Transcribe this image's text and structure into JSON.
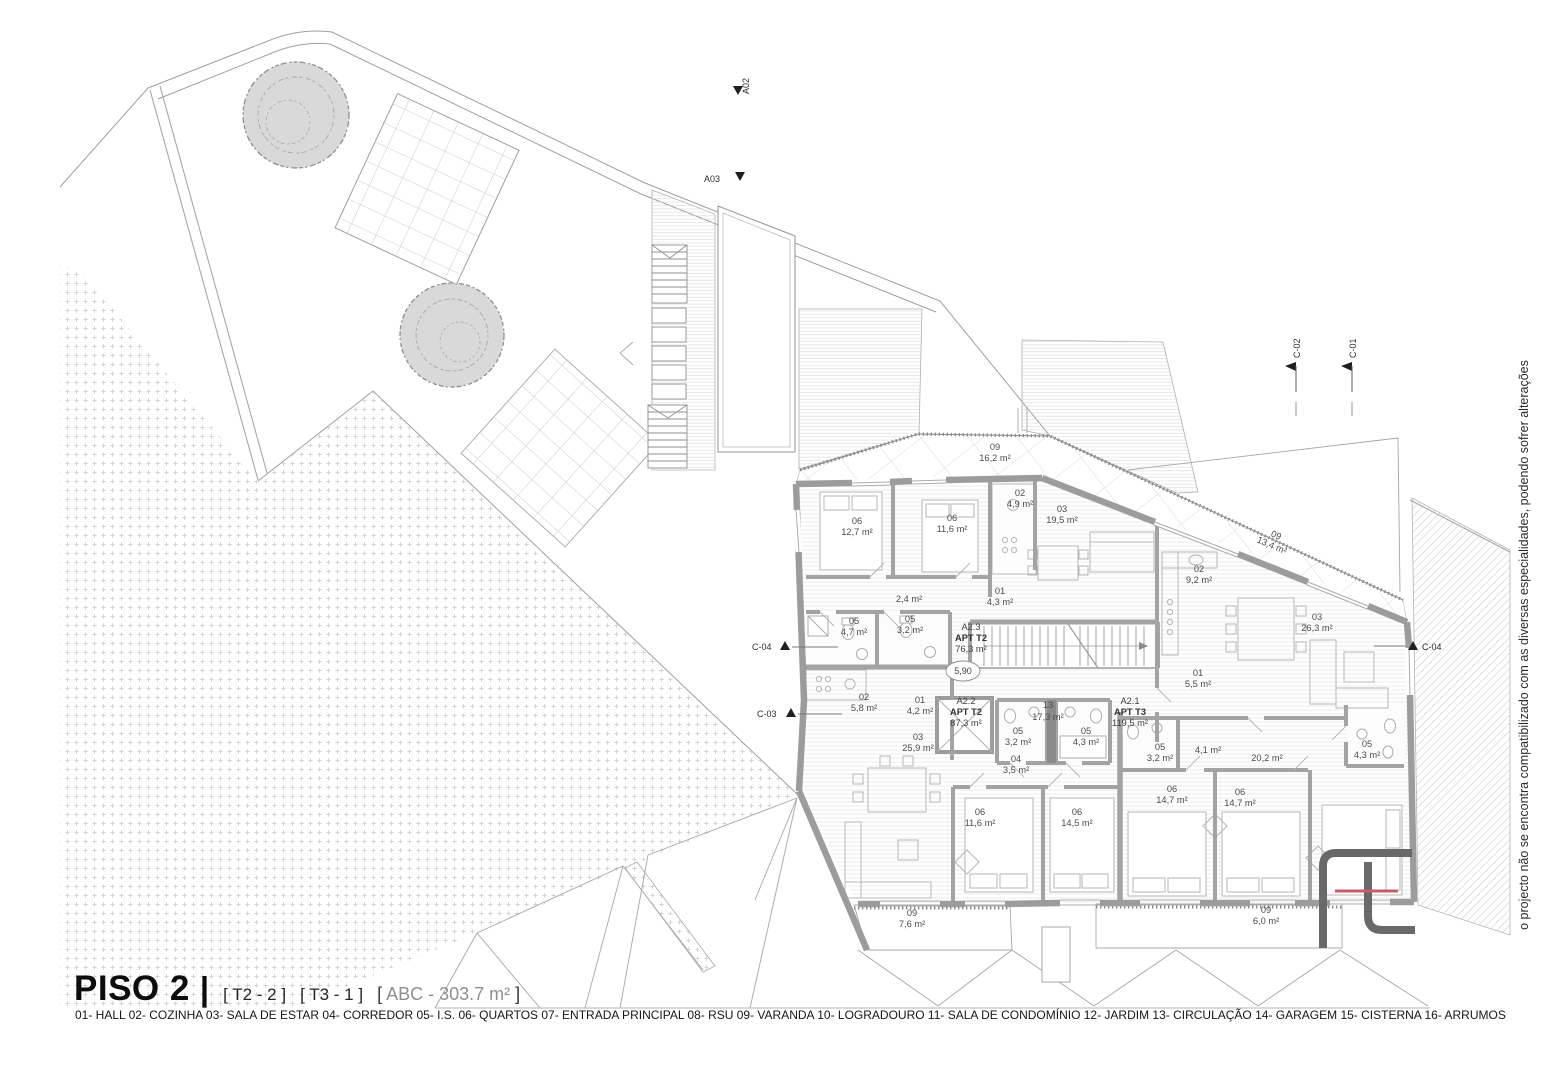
{
  "sheet": {
    "title": "PISO 2",
    "separator": "|",
    "tag_t2": "[ T2 - 2 ]",
    "tag_t3": "[ T3 - 1 ]",
    "abc_open": "[",
    "abc_text": "ABC - 303.7 m²",
    "abc_close": "]",
    "legend": "01- HALL 02- COZINHA 03- SALA DE ESTAR 04- CORREDOR 05- I.S. 06- QUARTOS 07- ENTRADA PRINCIPAL 08- RSU 09- VARANDA 10- LOGRADOURO 11- SALA DE CONDOMÍNIO 12- JARDIM 13- CIRCULAÇÃO 14- GARAGEM 15- CISTERNA 16- ARRUMOS",
    "side_note": "o projecto não se encontra compatibilizado com as diversas especialidades, podendo sofrer alterações"
  },
  "markers": {
    "a02": "A02",
    "a03": "A03",
    "c01": "C-01",
    "c02": "C-02",
    "c03": "C-03",
    "c04_left": "C-04",
    "c04_right": "C-04"
  },
  "level_marker": "5,90",
  "circulation": {
    "num": "13",
    "area": "17,3 m²",
    "x": 1048,
    "y": 708
  },
  "apartments": [
    {
      "code": "A2.3",
      "type": "APT T2",
      "area": "76,3 m²",
      "x": 971,
      "y": 630
    },
    {
      "code": "A2.2",
      "type": "APT T2",
      "area": "87,3 m²",
      "x": 966,
      "y": 704
    },
    {
      "code": "A2.1",
      "type": "APT T3",
      "area": "119,5 m²",
      "x": 1130,
      "y": 704
    }
  ],
  "rooms": [
    {
      "num": "09",
      "area": "16,2 m²",
      "x": 995,
      "y": 450
    },
    {
      "num": "06",
      "area": "12,7 m²",
      "x": 857,
      "y": 524
    },
    {
      "num": "06",
      "area": "11,6 m²",
      "x": 952,
      "y": 521
    },
    {
      "num": "02",
      "area": "4,9 m²",
      "x": 1020,
      "y": 496
    },
    {
      "num": "03",
      "area": "19,5 m²",
      "x": 1062,
      "y": 512
    },
    {
      "area": "2,4 m²",
      "x": 909,
      "y": 597
    },
    {
      "num": "01",
      "area": "4,3 m²",
      "x": 1000,
      "y": 594
    },
    {
      "num": "05",
      "area": "4,7 m²",
      "x": 854,
      "y": 624
    },
    {
      "num": "05",
      "area": "3,2 m²",
      "x": 910,
      "y": 622
    },
    {
      "num": "09",
      "area": "13,4 m²",
      "x": 1275,
      "y": 538,
      "rot": 23
    },
    {
      "num": "02",
      "area": "9,2 m²",
      "x": 1199,
      "y": 572
    },
    {
      "num": "03",
      "area": "26,3 m²",
      "x": 1317,
      "y": 620
    },
    {
      "num": "01",
      "area": "5,5 m²",
      "x": 1198,
      "y": 676
    },
    {
      "num": "02",
      "area": "5,8 m²",
      "x": 864,
      "y": 700
    },
    {
      "num": "01",
      "area": "4,2 m²",
      "x": 920,
      "y": 703
    },
    {
      "num": "03",
      "area": "25,9 m²",
      "x": 918,
      "y": 740
    },
    {
      "num": "05",
      "area": "3,2 m²",
      "x": 1018,
      "y": 734
    },
    {
      "num": "05",
      "area": "4,3 m²",
      "x": 1086,
      "y": 734
    },
    {
      "num": "04",
      "area": "3,5 m²",
      "x": 1016,
      "y": 762
    },
    {
      "num": "05",
      "area": "3,2 m²",
      "x": 1160,
      "y": 750
    },
    {
      "area": "4,1 m²",
      "x": 1208,
      "y": 748
    },
    {
      "area": "20,2 m²",
      "x": 1267,
      "y": 756
    },
    {
      "num": "05",
      "area": "4,3 m²",
      "x": 1367,
      "y": 747
    },
    {
      "num": "06",
      "area": "11,6 m²",
      "x": 980,
      "y": 815
    },
    {
      "num": "06",
      "area": "14,5 m²",
      "x": 1077,
      "y": 815
    },
    {
      "num": "06",
      "area": "14,7 m²",
      "x": 1172,
      "y": 792
    },
    {
      "num": "06",
      "area": "14,7 m²",
      "x": 1240,
      "y": 795
    },
    {
      "num": "09",
      "area": "7,6 m²",
      "x": 912,
      "y": 916
    },
    {
      "num": "09",
      "area": "6,0 m²",
      "x": 1266,
      "y": 913
    }
  ],
  "colors": {
    "accent_red": "#c25b6e",
    "logo_gray": "#696969",
    "wall_gray": "#9c9c9c"
  }
}
